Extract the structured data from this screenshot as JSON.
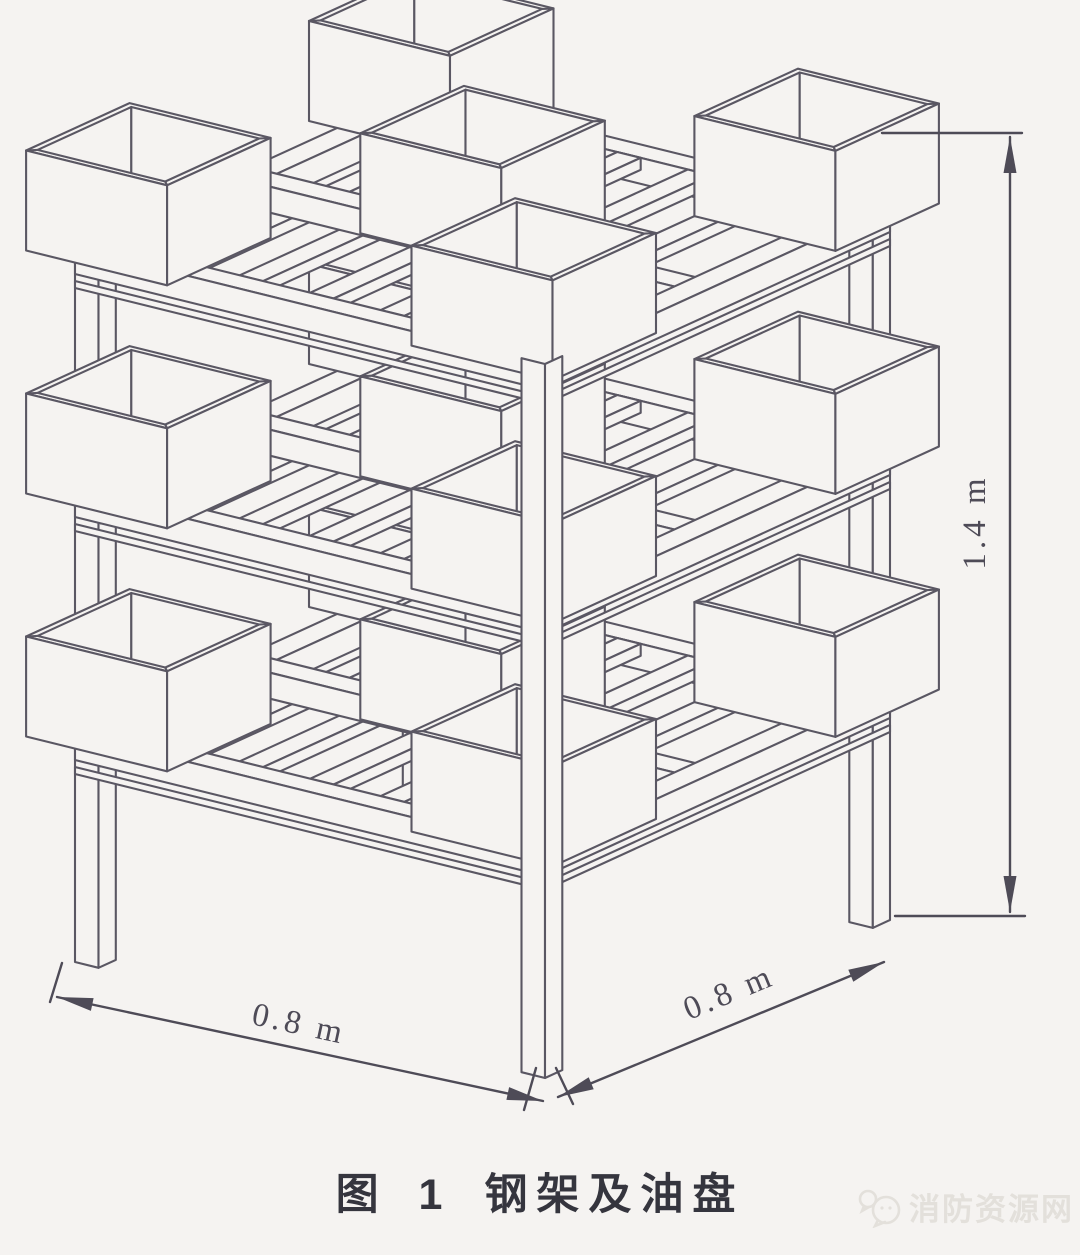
{
  "figure": {
    "number": "图 1",
    "title": "钢架及油盘",
    "watermark": "消防资源网"
  },
  "dimensions": {
    "width_left": "0.8 m",
    "width_right": "0.8 m",
    "height": "1.4 m"
  },
  "structure": {
    "tiers": 3,
    "pans_per_tier": 5,
    "legs": 4,
    "subject": "钢架及油盘"
  },
  "colors": {
    "paper": "#f5f3f1",
    "line": "#5a5763",
    "dim": "#4e4b57",
    "caption": "#35353e",
    "watermark": "#e3e0db"
  }
}
